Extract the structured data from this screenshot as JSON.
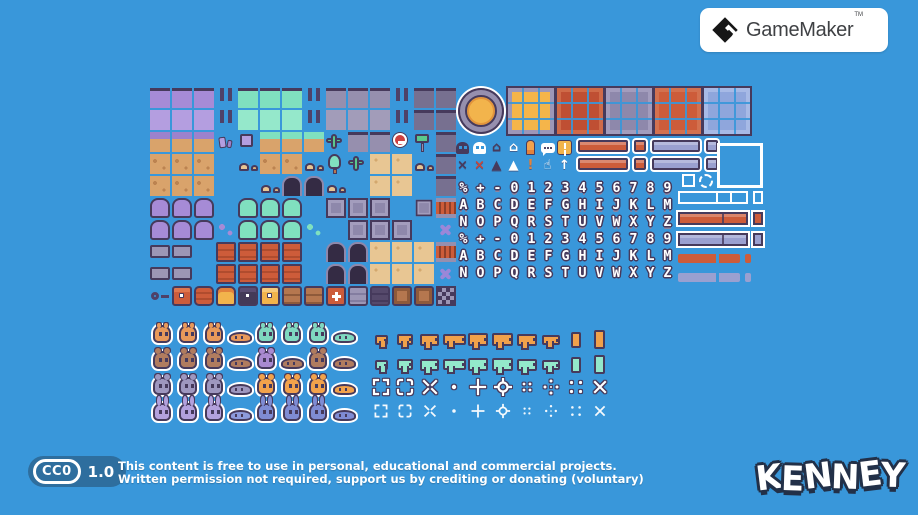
{
  "page": {
    "background": "#3997da"
  },
  "gamemaker_card": {
    "title": "GameMaker",
    "trademark": "TM"
  },
  "license": {
    "badge": "CC0",
    "version": "1.0",
    "line1": "This content is free to use in personal, educational and commercial projects.",
    "line2": "Written permission not required, support us by crediting or donating (voluntary)"
  },
  "kenney": {
    "logo": "KENNEY"
  },
  "sheet": {
    "colors": {
      "outline": "#463a5c",
      "purple_grass": "#a68bd6",
      "teal_grass": "#80e0bf",
      "stone": "#968fae",
      "dark_stone": "#777090",
      "dirt": "#d9a36b",
      "sand": "#e8c693",
      "orange": "#cd5c3a",
      "yellow": "#f2b44c",
      "lavender": "#9aa0d0",
      "blue_panel": "#8fa6dc"
    },
    "tile_map": [
      "PPP|TTT|SSS|GG",
      "ppp|ttt|sss|GG",
      "QQQCzUUUcSSnHG",
      "DDD.mDDmrcNNmG",
      "DDD..mAAm.NN.G",
      "WWW.VVV.EEE.ZF",
      "WWWBVVVb.EEE.x",
      "RR.OOOO.AANNNF",
      "RR.OOOO.AANNNx",
      "KkoqhyddMvwLLf"
    ],
    "tile_legend": {
      "P": "purple-grass-top",
      "p": "purple-grass-fill",
      "Q": "purple-dirt-transition",
      "T": "teal-grass-top",
      "t": "teal-grass-fill",
      "U": "teal-dirt-transition",
      "S": "stone-top",
      "s": "stone-fill",
      "G": "dark-stone",
      "D": "dirt",
      "N": "sand",
      "W": "purple-bush",
      "V": "teal-bush",
      "B": "purple-pebbles",
      "b": "teal-pebbles",
      "E": "metal-panel",
      "Z": "small-panel",
      "R": "gray-platform",
      "O": "orange-platform",
      "A": "doorway-arch",
      "F": "orange-fence",
      "f": "checker-block",
      "C": "crystals",
      "c": "cactus",
      "r": "tree",
      "m": "rocks",
      "K": "key",
      "k": "chest-orange",
      "h": "chest-dark",
      "y": "chest-yellow",
      "d": "drawer",
      "M": "medkit",
      "v": "locker-gray",
      "w": "locker-dark",
      "L": "shelf",
      "x": "shuriken",
      "n": "no-entry-sign",
      "H": "sign-post",
      "i": "pickup",
      "z": "purple-block",
      "o": "barrel",
      "q": "jar",
      "|": "hanging-posts",
      ".": "empty"
    },
    "coin": {
      "ring": "#968fae",
      "center": "#f2b44c"
    },
    "panels": [
      {
        "name": "panel-yellow",
        "fill": "#f5b54a",
        "frame": "#9d97b8"
      },
      {
        "name": "panel-red",
        "fill": "#bf4f33",
        "frame": "#cf6a48"
      },
      {
        "name": "panel-lavender",
        "fill": "#8e88ab",
        "frame": "#a39dbd"
      },
      {
        "name": "panel-orange",
        "fill": "#cd5c3a",
        "frame": "#d3714f"
      },
      {
        "name": "panel-blue",
        "fill": "#8fa6dc",
        "frame": "#a7bae6"
      }
    ],
    "icons": {
      "rows": [
        [
          {
            "name": "skull-icon-dark",
            "type": "skull",
            "color": "#463a5c"
          },
          {
            "name": "skull-icon-white",
            "type": "skull",
            "color": "#ffffff"
          },
          {
            "name": "home-icon-dark",
            "glyph": "⌂",
            "color": "#463a5c"
          },
          {
            "name": "home-icon-white",
            "glyph": "⌂",
            "color": "#ffffff"
          },
          {
            "name": "bullet-icon",
            "type": "bullet"
          },
          {
            "name": "speech-bubble-icon",
            "type": "speech"
          },
          {
            "name": "warning-icon",
            "type": "warning"
          }
        ],
        [
          {
            "name": "cross-icon-dark",
            "glyph": "×",
            "color": "#463a5c"
          },
          {
            "name": "cross-icon-red",
            "glyph": "×",
            "color": "#c94537"
          },
          {
            "name": "triangle-icon-dark",
            "glyph": "▲",
            "color": "#463a5c"
          },
          {
            "name": "triangle-icon-white",
            "glyph": "▲",
            "color": "#ffffff"
          },
          {
            "name": "exclamation-icon",
            "glyph": "!",
            "color": "#e2823c"
          },
          {
            "name": "hand-icon",
            "glyph": "☝",
            "color": "#ffffff"
          },
          {
            "name": "arrow-up-icon",
            "glyph": "↑",
            "color": "#ffffff"
          }
        ]
      ]
    },
    "button_bars": {
      "row_count": 2,
      "items": [
        {
          "name": "bar-orange-wide",
          "color": "#cd5c3a",
          "w": 50
        },
        {
          "name": "bar-orange-small",
          "color": "#cd5c3a",
          "w": 12
        },
        {
          "name": "bar-lavender-wide",
          "color": "#9aa0d0",
          "w": 48
        },
        {
          "name": "bar-lavender-small",
          "color": "#9aa0d0",
          "w": 12
        }
      ]
    },
    "fonts": {
      "outlined": [
        "%+-0123456789",
        "ABCDEFGHIJKLM",
        "NOPQRSTUVWXYZ"
      ],
      "flat": [
        "%+-0123456789",
        "ABCDEFGHIJKLM",
        "NOPQRSTUVWXYZ"
      ]
    },
    "progress_bars": [
      {
        "name": "progress-outline",
        "kind": "outline",
        "color": "#ffffff"
      },
      {
        "name": "progress-orange",
        "kind": "boxed",
        "color": "#cd5c3a"
      },
      {
        "name": "progress-lavender",
        "kind": "boxed",
        "color": "#9aa0d0"
      },
      {
        "name": "progress-orange-flat",
        "kind": "flat",
        "color": "#cd5c3a"
      },
      {
        "name": "progress-lavender-flat",
        "kind": "flat",
        "color": "#9aa0d0"
      }
    ],
    "characters": {
      "rows": [
        {
          "ears": "small",
          "items": [
            {
              "n": "squirrel",
              "c": "#e8995a",
              "v": "sit"
            },
            {
              "n": "squirrel",
              "c": "#e8995a",
              "v": "sit"
            },
            {
              "n": "squirrel",
              "c": "#e8995a",
              "v": "sit"
            },
            {
              "n": "squirrel-sleeping",
              "c": "#e8995a",
              "v": "sleep"
            },
            {
              "n": "turtle",
              "c": "#7fd8c0",
              "v": "sit"
            },
            {
              "n": "turtle",
              "c": "#7fd8c0",
              "v": "sit"
            },
            {
              "n": "turtle",
              "c": "#7fd8c0",
              "v": "sit"
            },
            {
              "n": "turtle-sleeping",
              "c": "#7fd8c0",
              "v": "sleep"
            }
          ]
        },
        {
          "ears": "round",
          "items": [
            {
              "n": "monkey",
              "c": "#b07c5f",
              "v": "sit"
            },
            {
              "n": "monkey",
              "c": "#b07c5f",
              "v": "sit"
            },
            {
              "n": "monkey",
              "c": "#b07c5f",
              "v": "sit"
            },
            {
              "n": "monkey-sleeping",
              "c": "#b07c5f",
              "v": "sleep"
            },
            {
              "n": "butterfly",
              "c": "#a98ad0",
              "v": "sit"
            },
            {
              "n": "sloth",
              "c": "#b07c5f",
              "v": "sleep"
            },
            {
              "n": "hamster",
              "c": "#b07c5f",
              "v": "sit"
            },
            {
              "n": "hamster-sleeping",
              "c": "#b07c5f",
              "v": "sleep"
            }
          ]
        },
        {
          "ears": "round",
          "items": [
            {
              "n": "mouse",
              "c": "#9e97bf",
              "v": "sit"
            },
            {
              "n": "mouse",
              "c": "#9e97bf",
              "v": "sit"
            },
            {
              "n": "mouse",
              "c": "#9e97bf",
              "v": "sit"
            },
            {
              "n": "mouse-sleeping",
              "c": "#9e97bf",
              "v": "sleep"
            },
            {
              "n": "chick",
              "c": "#f2a24b",
              "v": "sit"
            },
            {
              "n": "chick",
              "c": "#f2a24b",
              "v": "sit"
            },
            {
              "n": "chick",
              "c": "#f2a24b",
              "v": "sit"
            },
            {
              "n": "chick-sleeping",
              "c": "#f2a24b",
              "v": "sleep"
            }
          ]
        },
        {
          "ears": "tall",
          "items": [
            {
              "n": "bunny",
              "c": "#b3a1dd",
              "v": "sit"
            },
            {
              "n": "bunny",
              "c": "#b3a1dd",
              "v": "sit"
            },
            {
              "n": "bunny",
              "c": "#b3a1dd",
              "v": "sit"
            },
            {
              "n": "bunny-sleeping",
              "c": "#8d9bdc",
              "v": "sleep"
            },
            {
              "n": "frog",
              "c": "#7f8cd4",
              "v": "sit"
            },
            {
              "n": "frog",
              "c": "#7f8cd4",
              "v": "sit"
            },
            {
              "n": "frog",
              "c": "#7f8cd4",
              "v": "sit"
            },
            {
              "n": "frog-sleeping",
              "c": "#7f8cd4",
              "v": "sleep"
            }
          ]
        }
      ]
    },
    "weapons": {
      "rows": [
        {
          "name": "weapons-orange",
          "color": "#f0a14b"
        },
        {
          "name": "weapons-teal",
          "color": "#93e8cb"
        }
      ],
      "kinds": [
        {
          "n": "pistol-small",
          "w": 9,
          "h": 6
        },
        {
          "n": "pistol",
          "w": 12,
          "h": 7
        },
        {
          "n": "raygun",
          "w": 15,
          "h": 8
        },
        {
          "n": "rifle",
          "w": 19,
          "h": 7
        },
        {
          "n": "smg",
          "w": 16,
          "h": 9
        },
        {
          "n": "assault-rifle",
          "w": 17,
          "h": 9
        },
        {
          "n": "carbine",
          "w": 16,
          "h": 8
        },
        {
          "n": "blaster",
          "w": 14,
          "h": 6
        },
        {
          "n": "magazine",
          "w": 6,
          "h": 12,
          "vert": true
        },
        {
          "n": "spear",
          "w": 7,
          "h": 15,
          "vert": true
        }
      ]
    },
    "crosshairs": {
      "kinds": [
        "corners",
        "corners-round",
        "x-arrows",
        "dot",
        "plus",
        "target",
        "dots-grid",
        "diamond-dots",
        "quad-dots",
        "x-mark"
      ]
    }
  }
}
